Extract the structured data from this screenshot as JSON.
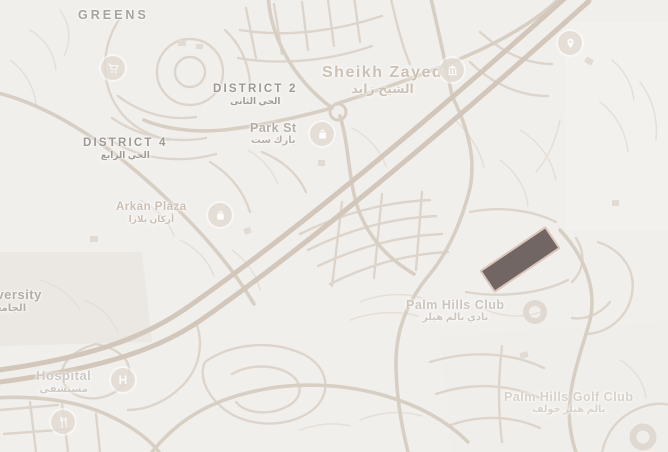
{
  "map": {
    "type": "street-map-snapshot",
    "palette": {
      "background": "#f1efec",
      "road_thin": "#e5dfd8",
      "road_medium": "#ddd5cb",
      "road_major": "#d8cfc4",
      "corridor": "#d2c7ba",
      "district_label": "#9c9893",
      "poi_label_tan": "#cbbfb3",
      "plot_fill": "#675a58",
      "plot_border": "#dbc6bd"
    },
    "highlighted_plot": {
      "x": 480,
      "y": 246,
      "width": 80,
      "height": 27,
      "rotation_deg": -34,
      "fill": "rgba(103,90,88,0.92)",
      "border": "#dbc6bd"
    },
    "labels": [
      {
        "id": "greens",
        "text": "GREENS",
        "arabic": "",
        "x": 78,
        "y": 8,
        "size": 12.5,
        "color": "#a7a39e",
        "spacing": 3,
        "weight": 700
      },
      {
        "id": "district-2",
        "text": "DISTRICT 2",
        "arabic": "الحي الثانى",
        "x": 213,
        "y": 83,
        "size": 11.5,
        "color": "#9c9893",
        "spacing": 2.2,
        "weight": 700
      },
      {
        "id": "district-4",
        "text": "DISTRICT 4",
        "arabic": "الحي الرابع",
        "x": 83,
        "y": 137,
        "size": 11.5,
        "color": "#9c9893",
        "spacing": 2.2,
        "weight": 700
      },
      {
        "id": "sheikh-zayed",
        "text": "Sheikh Zayed",
        "arabic": "الشيخ زايد",
        "x": 322,
        "y": 64,
        "size": 16,
        "color": "#ccc1b4",
        "spacing": 1.5,
        "weight": 600
      },
      {
        "id": "park-st",
        "text": "Park St",
        "arabic": "بارك ست",
        "x": 250,
        "y": 121,
        "size": 12.5,
        "color": "#b5aea6",
        "spacing": 0.5,
        "weight": 600
      },
      {
        "id": "arkan-plaza",
        "text": "Arkan Plaza",
        "arabic": "أركان بلازا",
        "x": 116,
        "y": 201,
        "size": 11.5,
        "color": "#cbbfb3",
        "spacing": 0.5,
        "weight": 600
      },
      {
        "id": "university",
        "text": "University",
        "arabic": "الجامعة",
        "x": -26,
        "y": 288,
        "size": 13,
        "color": "#b2aca5",
        "spacing": 0.5,
        "weight": 600
      },
      {
        "id": "hospital",
        "text": "Hospital",
        "arabic": "مستشفى",
        "x": 36,
        "y": 369,
        "size": 13,
        "color": "#cfc9c2",
        "spacing": 0.5,
        "weight": 600
      },
      {
        "id": "palm-hills-club",
        "text": "Palm Hills Club",
        "arabic": "نادي بالم هيلز",
        "x": 406,
        "y": 298,
        "size": 12.5,
        "color": "#ccc5be",
        "spacing": 0.5,
        "weight": 600
      },
      {
        "id": "palm-hills-golf-club",
        "text": "Palm Hills Golf Club",
        "arabic": "بالم هيلز جولف",
        "x": 504,
        "y": 390,
        "size": 12.5,
        "color": "#d7d1ca",
        "spacing": 0.5,
        "weight": 600
      }
    ],
    "pois": [
      {
        "icon": "shopping-cart-icon",
        "x": 113,
        "y": 68
      },
      {
        "icon": "shopping-bag-icon",
        "x": 322,
        "y": 134
      },
      {
        "icon": "shopping-bag-icon",
        "x": 220,
        "y": 215
      },
      {
        "icon": "landmark-icon",
        "x": 452,
        "y": 70
      },
      {
        "icon": "map-pin-icon",
        "x": 570,
        "y": 43
      },
      {
        "icon": "hospital-icon",
        "x": 123,
        "y": 380,
        "letter": "H"
      },
      {
        "icon": "restaurant-icon",
        "x": 63,
        "y": 422
      }
    ]
  }
}
